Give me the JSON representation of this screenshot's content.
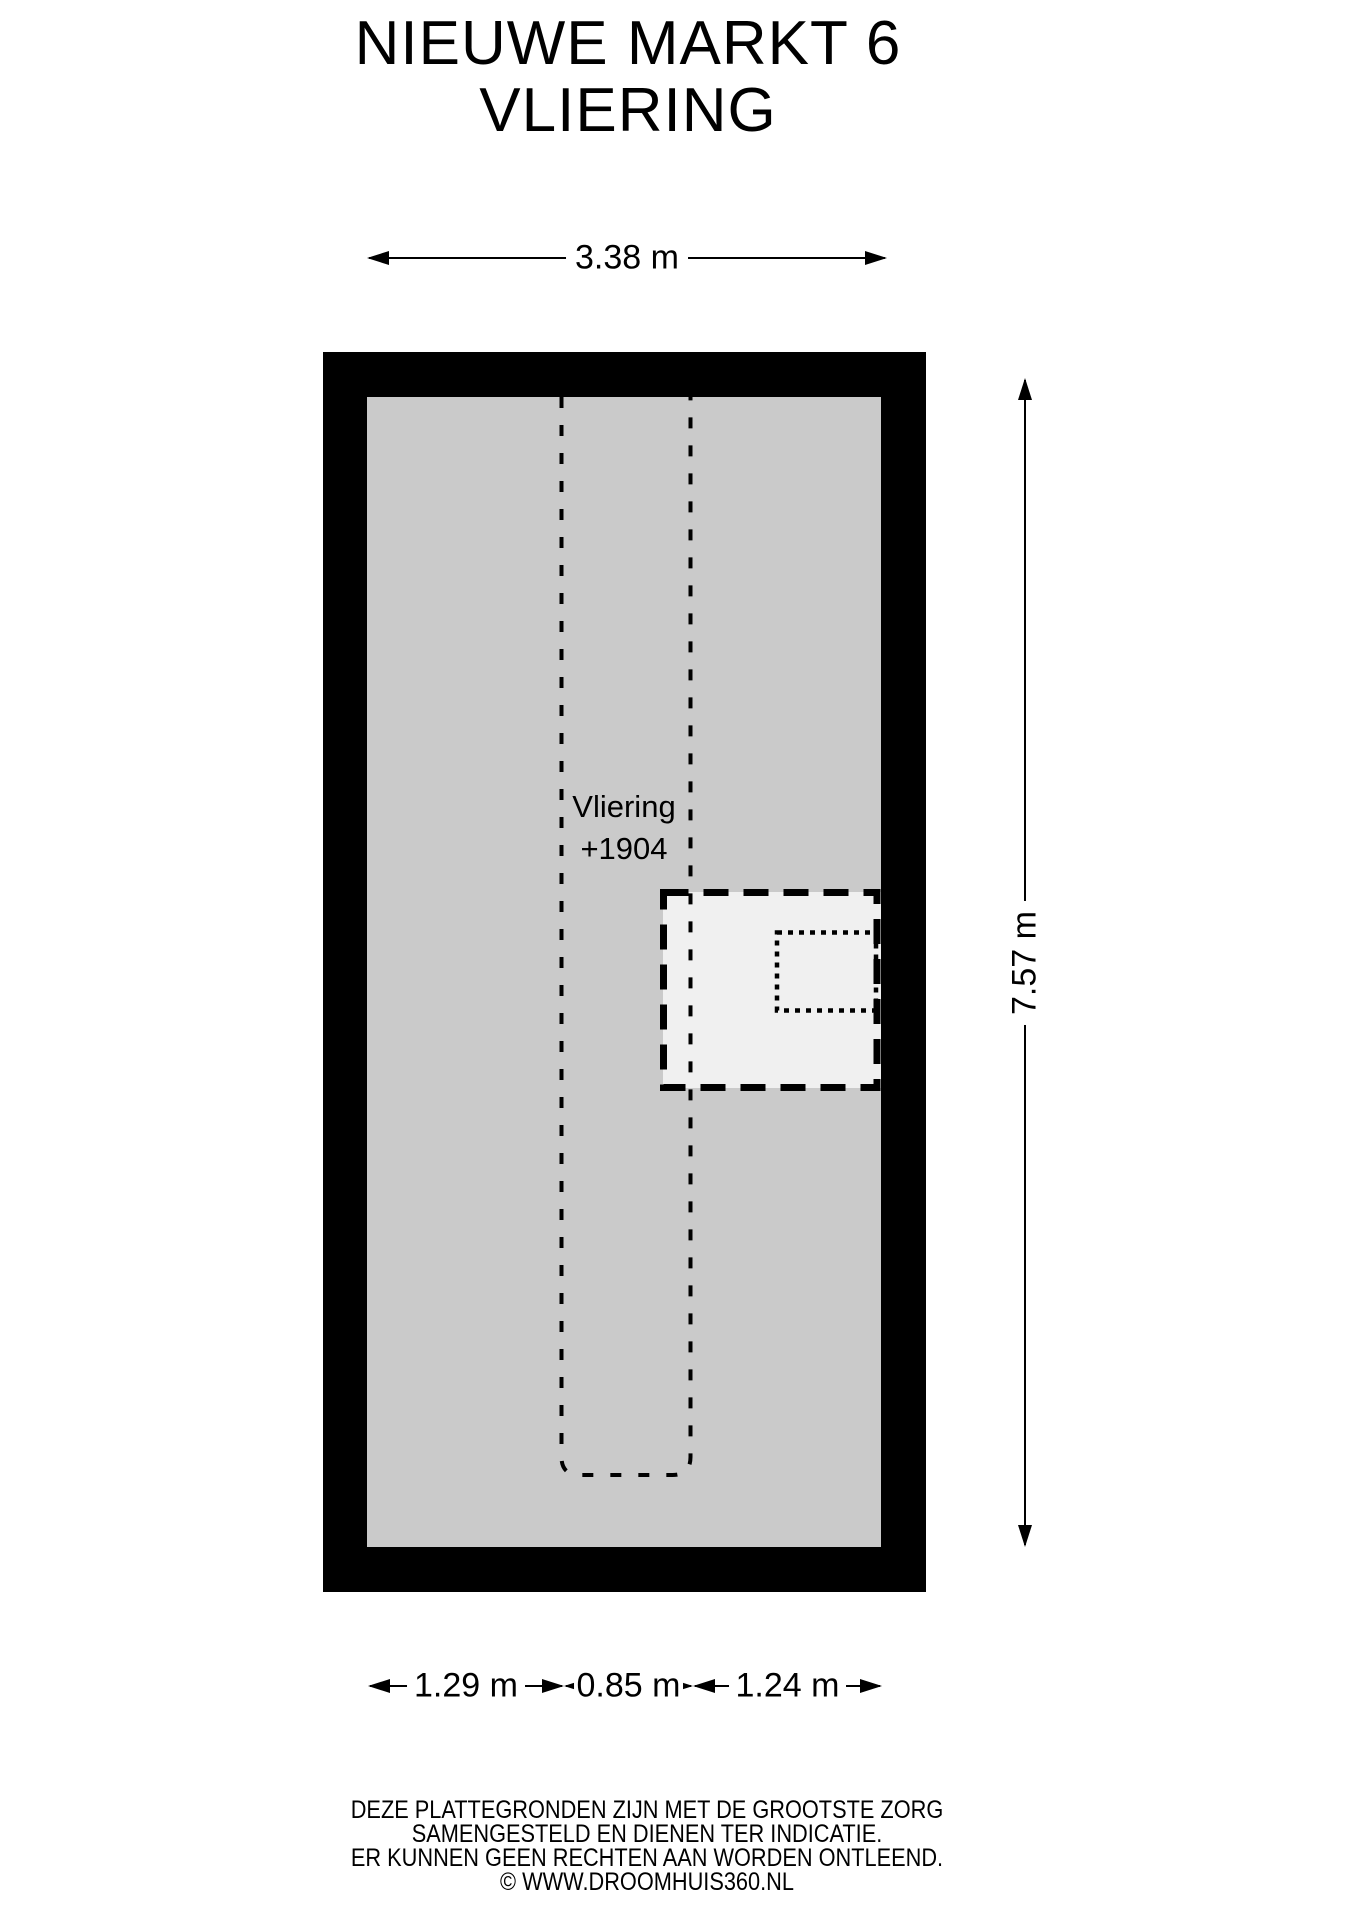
{
  "title": {
    "line1": "NIEUWE MARKT 6",
    "line2": "VLIERING"
  },
  "room": {
    "name": "Vliering",
    "elevation": "+1904"
  },
  "dimensions": {
    "top_width": "3.38 m",
    "right_height": "7.57 m",
    "bottom_segments": [
      {
        "label": "1.29 m"
      },
      {
        "label": "0.85 m"
      },
      {
        "label": "1.24 m"
      }
    ]
  },
  "footer": {
    "line1": "DEZE PLATTEGRONDEN ZIJN MET DE GROOTSTE ZORG",
    "line2": "SAMENGESTELD EN DIENEN TER INDICATIE.",
    "line3": "ER KUNNEN GEEN RECHTEN AAN WORDEN ONTLEEND.",
    "line4": "© WWW.DROOMHUIS360.NL"
  },
  "colors": {
    "wall": "#000000",
    "line": "#000000",
    "floor": "#cacaca",
    "vide_fill": "#f0f0f0",
    "background": "#ffffff",
    "text": "#000000"
  }
}
